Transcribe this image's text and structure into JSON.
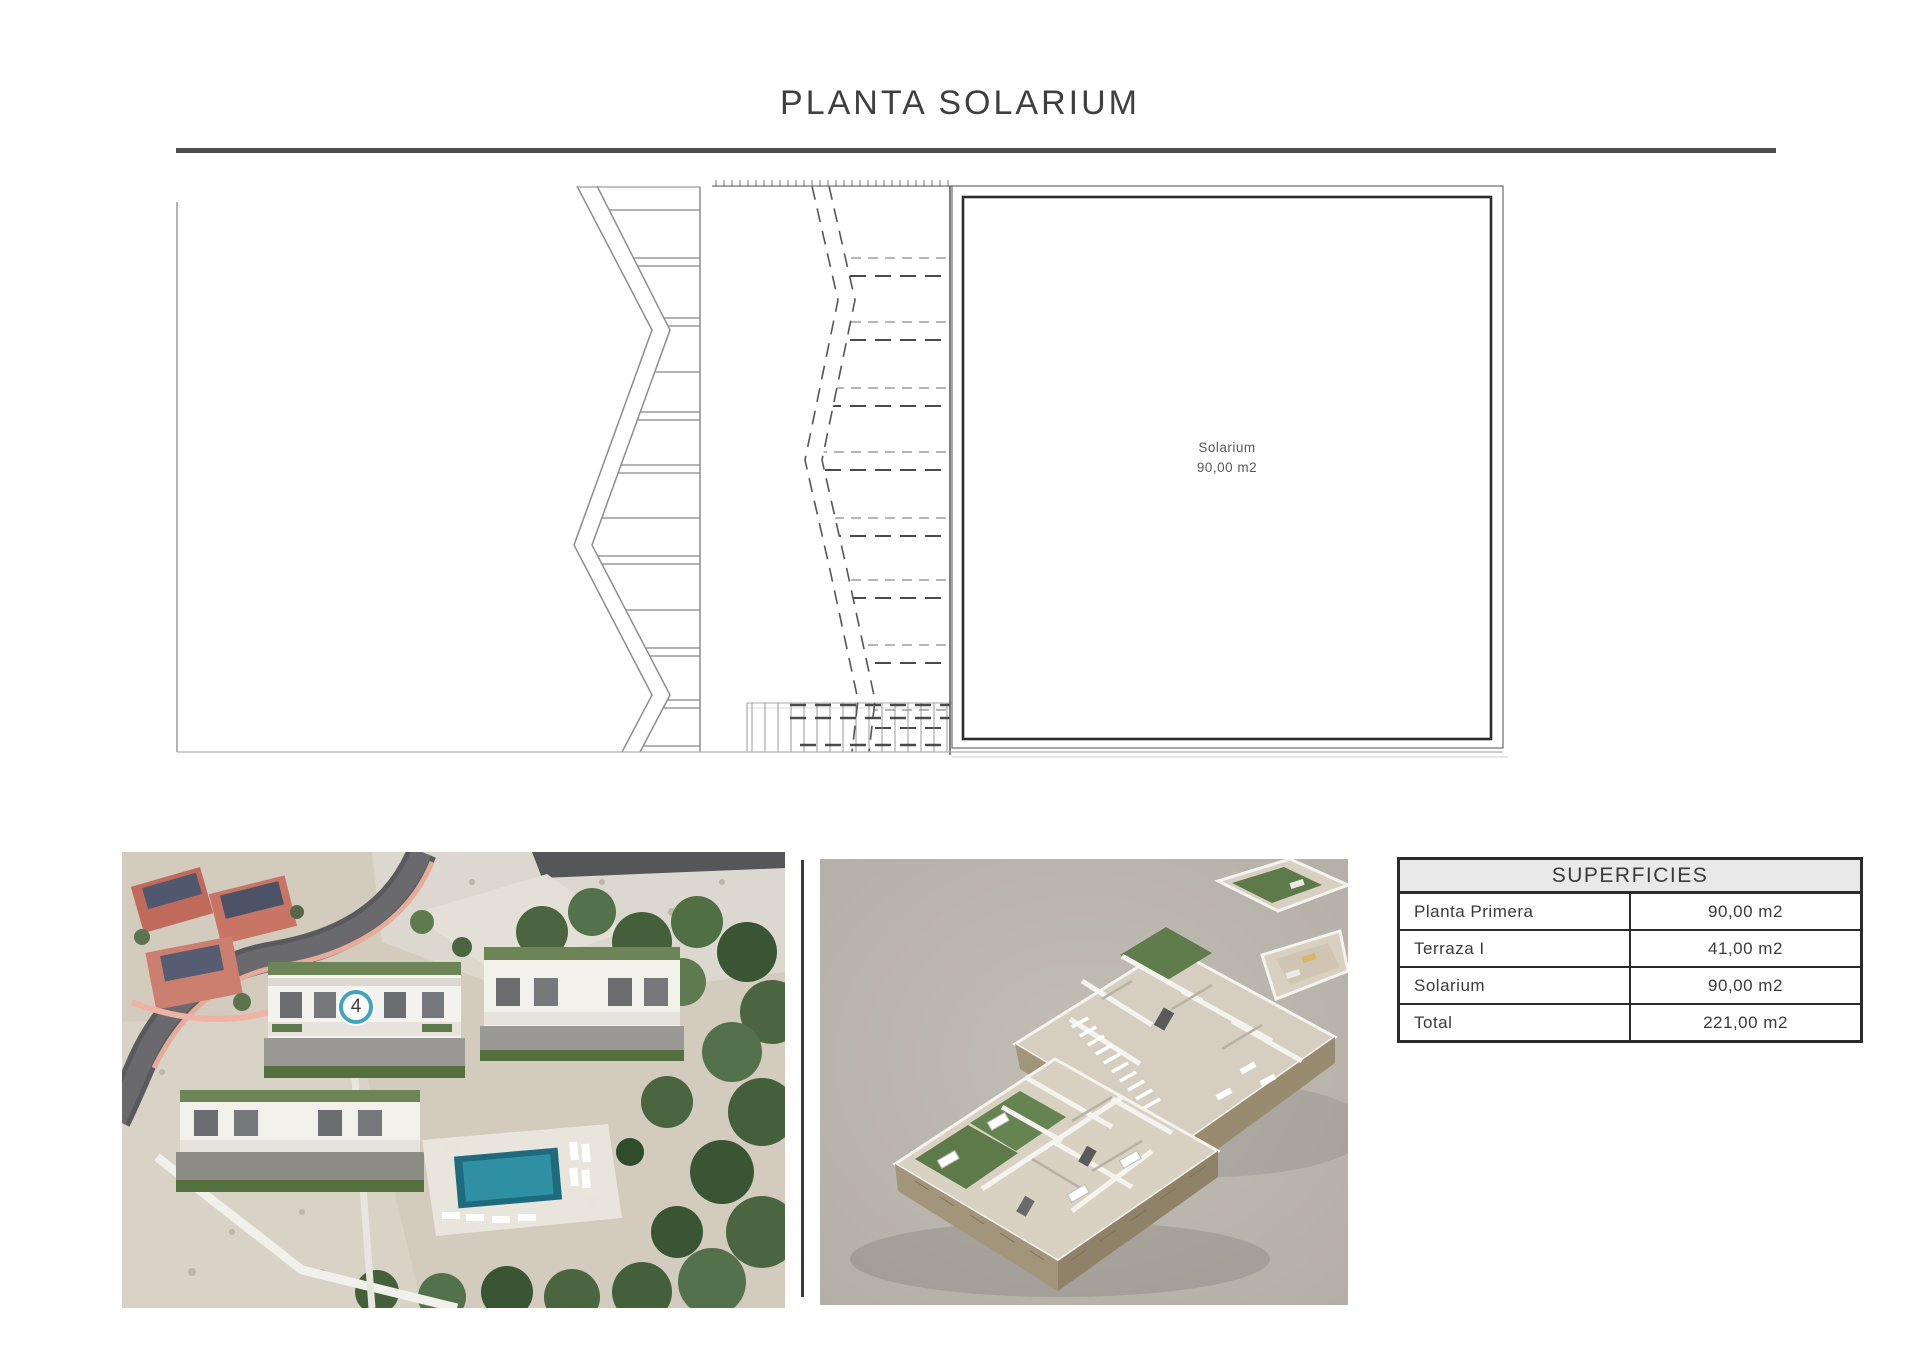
{
  "page": {
    "title": "PLANTA SOLARIUM"
  },
  "floor_plan": {
    "room_label": "Solarium",
    "room_area": "90,00 m2"
  },
  "site_photo": {
    "unit_badge": "4"
  },
  "superficies_table": {
    "header": "SUPERFICIES",
    "rows": [
      {
        "label": "Planta Primera",
        "value": "90,00 m2"
      },
      {
        "label": "Terraza I",
        "value": "41,00 m2"
      },
      {
        "label": "Solarium",
        "value": "90,00 m2"
      },
      {
        "label": "Total",
        "value": "221,00 m2"
      }
    ]
  },
  "colors": {
    "accent_teal": "#41a4ba",
    "title_rule": "#4f4f4f",
    "plan_line_dark": "#2e2e2e",
    "plan_line_mid": "#8d8d8d",
    "plan_line_light": "#b0b0b0",
    "table_border": "#2b2b2b",
    "table_header_bg": "#e9e9e9",
    "text": "#3c3c3c",
    "render_bg": "#b8b3ab"
  }
}
